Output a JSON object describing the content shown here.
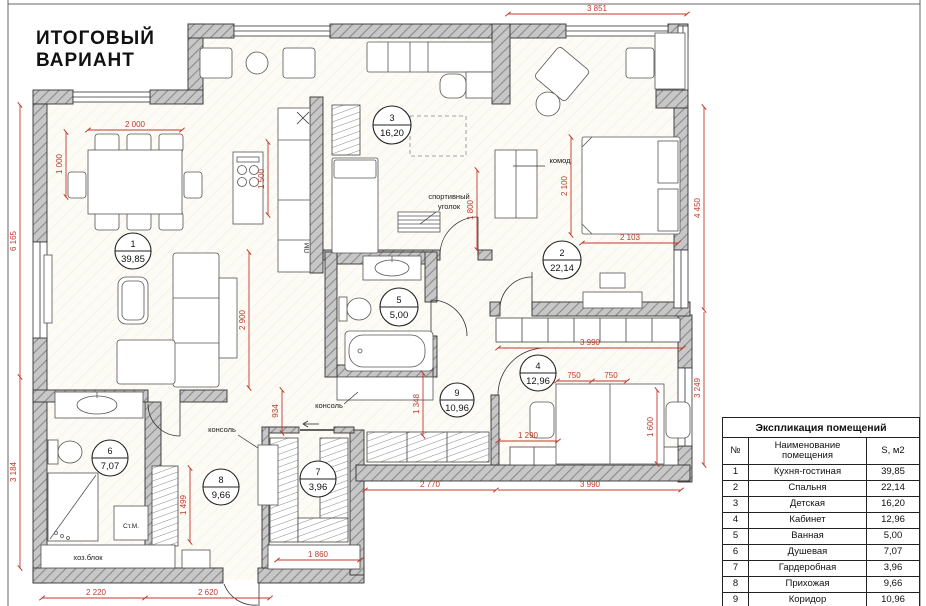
{
  "title": {
    "line1": "ИТОГОВЫЙ",
    "line2": "ВАРИАНТ"
  },
  "colors": {
    "dimension_red": "#c0392b",
    "wall_gray": "#bdbdbd",
    "line_black": "#222222"
  },
  "rooms": [
    {
      "num": "1",
      "name": "Кухня-гостиная",
      "area": "39,85"
    },
    {
      "num": "2",
      "name": "Спальня",
      "area": "22,14"
    },
    {
      "num": "3",
      "name": "Детская",
      "area": "16,20"
    },
    {
      "num": "4",
      "name": "Кабинет",
      "area": "12,96"
    },
    {
      "num": "5",
      "name": "Ванная",
      "area": "5,00"
    },
    {
      "num": "6",
      "name": "Душевая",
      "area": "7,07"
    },
    {
      "num": "7",
      "name": "Гардеробная",
      "area": "3,96"
    },
    {
      "num": "8",
      "name": "Прихожая",
      "area": "9,66"
    },
    {
      "num": "9",
      "name": "Коридор",
      "area": "10,96"
    }
  ],
  "table": {
    "title": "Экспликация помещений",
    "col_num": "№",
    "col_name": "Наименование помещения",
    "col_area": "S, м2",
    "total": "127,80 м²"
  },
  "dims": {
    "t3851": "3 851",
    "l6165": "6 165",
    "l3184": "3 184",
    "r4450": "4 450",
    "r3249": "3 249",
    "d2000": "2 000",
    "d1000": "1 000",
    "d1500": "1 500",
    "d2900": "2 900",
    "d1800": "1 800",
    "d2100": "2 100",
    "d2103": "2 103",
    "d3990a": "3 990",
    "d750a": "750",
    "d750b": "750",
    "d1290": "1 290",
    "d1600": "1 600",
    "d1348": "1 348",
    "d934": "934",
    "d1499": "1 499",
    "d1860": "1 860",
    "d2220": "2 220",
    "d2620": "2 620",
    "d2770": "2 770",
    "d3990b": "3 990"
  },
  "labels": {
    "komod": "комод",
    "sport1": "спортивный",
    "sport2": "уголок",
    "konsol_bath": "консоль",
    "konsol_hall": "консоль",
    "hozblok": "хоз.блок",
    "stm": "Ст.М.",
    "pm": "ПМ"
  }
}
